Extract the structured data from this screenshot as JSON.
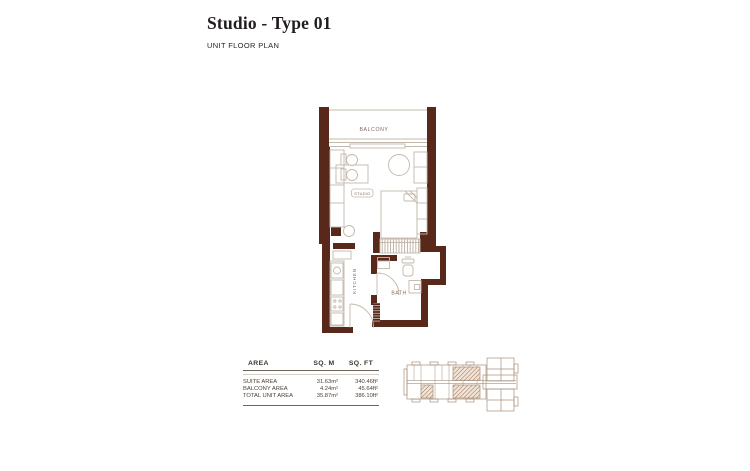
{
  "page": {
    "title": "Studio - Type 01",
    "subtitle": "UNIT FLOOR PLAN"
  },
  "floor_plan": {
    "room_labels": {
      "balcony": "BALCONY",
      "studio": "STUDIO",
      "kitchen": "KITCHEN",
      "bath": "BATH"
    }
  },
  "area_table": {
    "columns": {
      "area": "AREA",
      "sqm": "SQ. M",
      "sqft": "SQ. FT"
    },
    "rows": [
      {
        "label": "SUITE AREA",
        "sqm": "31.63m²",
        "sqft": "340.46ft²"
      },
      {
        "label": "BALCONY AREA",
        "sqm": "4.24m²",
        "sqft": "45.64ft²"
      },
      {
        "label": "TOTAL UNIT AREA",
        "sqm": "35.87m²",
        "sqft": "386.10ft²"
      }
    ]
  },
  "colors": {
    "wall": "#58291a",
    "furniture_line": "#c3b8ac",
    "room_label": "#82695a",
    "keyplan_outline": "#a8907a",
    "keyplan_hatch": "#9b7050"
  }
}
